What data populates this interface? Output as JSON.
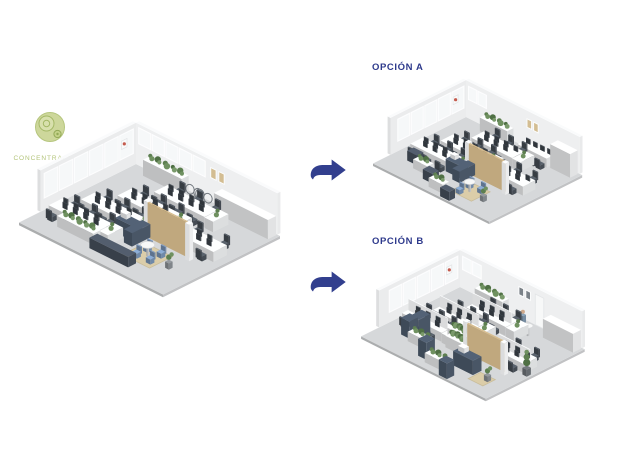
{
  "logo": {
    "label": "CONCENTRACIÓN",
    "icon": "concentric-circles-logo",
    "text_color": "#b3c47a",
    "fill": "#cdd79b",
    "ring": "#a3b765",
    "dot": "#93a957"
  },
  "options": [
    {
      "label": "OPCIÓN A"
    },
    {
      "label": "OPCIÓN B"
    }
  ],
  "label_color": "#2e3a8c",
  "arrow_color": "#323f8e",
  "scene_colors": {
    "floor": "#d6d8da",
    "wall": "#f0f1f2",
    "window": "#f6f8f9",
    "desk": "#edeff0",
    "white": "#f3f4f5",
    "chair": "#454c54",
    "monitor": "#3c434b",
    "navy": "#4e5c6e",
    "bench": "#46505d",
    "tan": "#c0a87e",
    "rug": "#dbcda9",
    "blue": "#7590b2",
    "frame": "#d3bd92",
    "frame_dark": "#7b8288",
    "pot": "#8a8f94",
    "skin": "#cfa98b",
    "shirt": "#7f97ad",
    "greens": [
      "#5d7f50",
      "#6f9160",
      "#4f7044",
      "#7a9a6b"
    ]
  }
}
